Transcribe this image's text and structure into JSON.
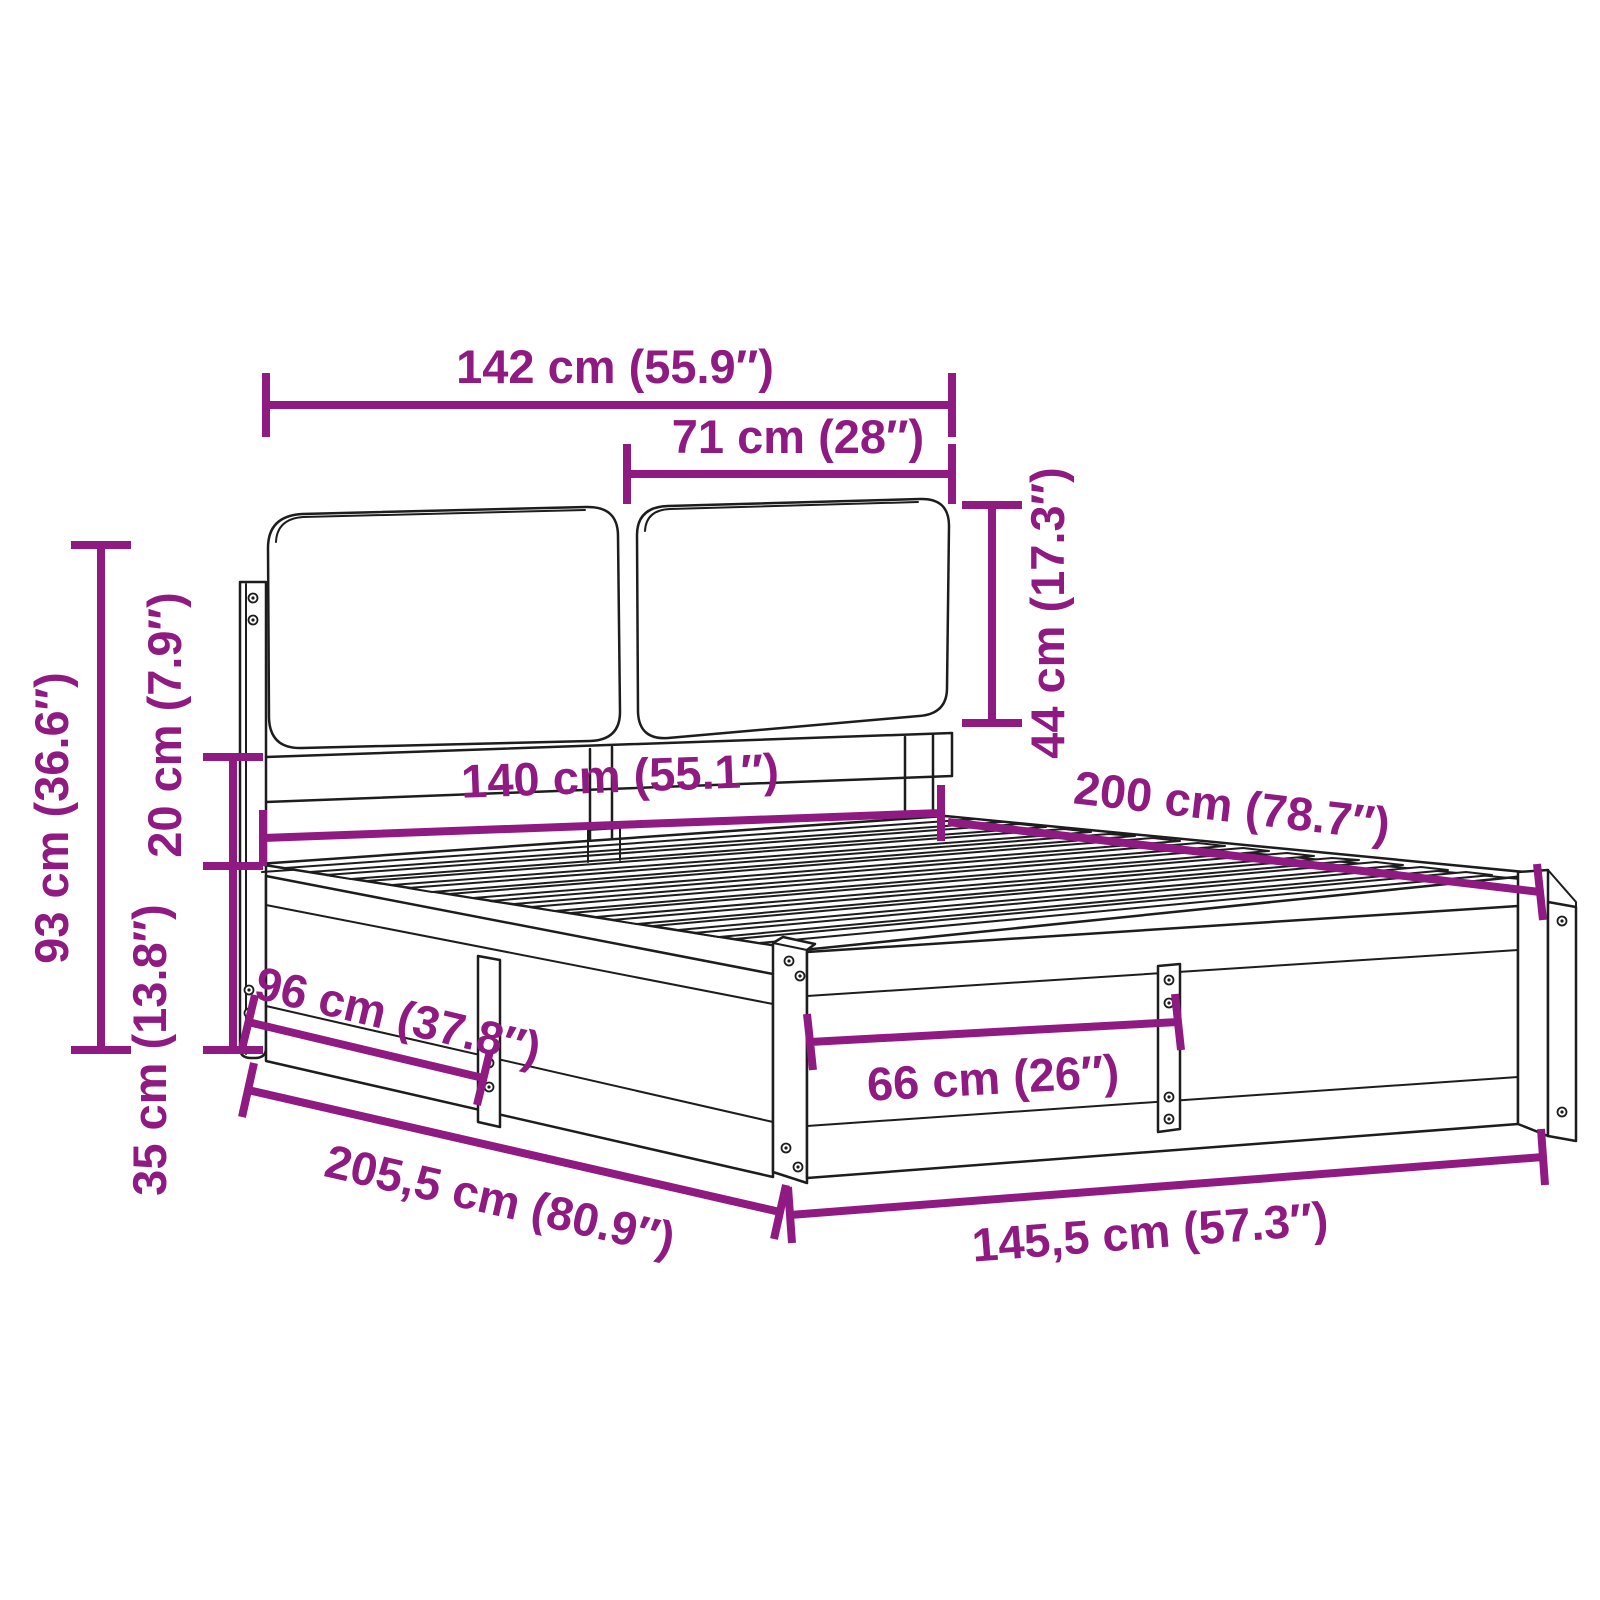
{
  "diagram": {
    "type": "product-dimension-diagram",
    "subject": "bed frame with cushioned headboard",
    "background_color": "#ffffff",
    "outline_color": "#1d1d1d",
    "accent_color": "#8e1a82",
    "units": "cm / inches",
    "dimensions": [
      {
        "id": "headboard-total-width",
        "label": "142 cm (55.9″)"
      },
      {
        "id": "headboard-cushion-width",
        "label": "71 cm (28″)"
      },
      {
        "id": "headboard-cushion-height",
        "label": "44 cm (17.3″)"
      },
      {
        "id": "headboard-height",
        "label": "93 cm (36.6″)"
      },
      {
        "id": "cushion-to-frame-gap",
        "label": "20 cm (7.9″)"
      },
      {
        "id": "frame-height",
        "label": "35 cm (13.8″)"
      },
      {
        "id": "mattress-width",
        "label": "140 cm (55.1″)"
      },
      {
        "id": "mattress-length",
        "label": "200 cm (78.7″)"
      },
      {
        "id": "side-panel-section",
        "label": "96 cm (37.8″)"
      },
      {
        "id": "foot-panel-section",
        "label": "66 cm (26″)"
      },
      {
        "id": "total-length",
        "label": "205,5 cm (80.9″)"
      },
      {
        "id": "total-width",
        "label": "145,5 cm (57.3″)"
      }
    ]
  }
}
